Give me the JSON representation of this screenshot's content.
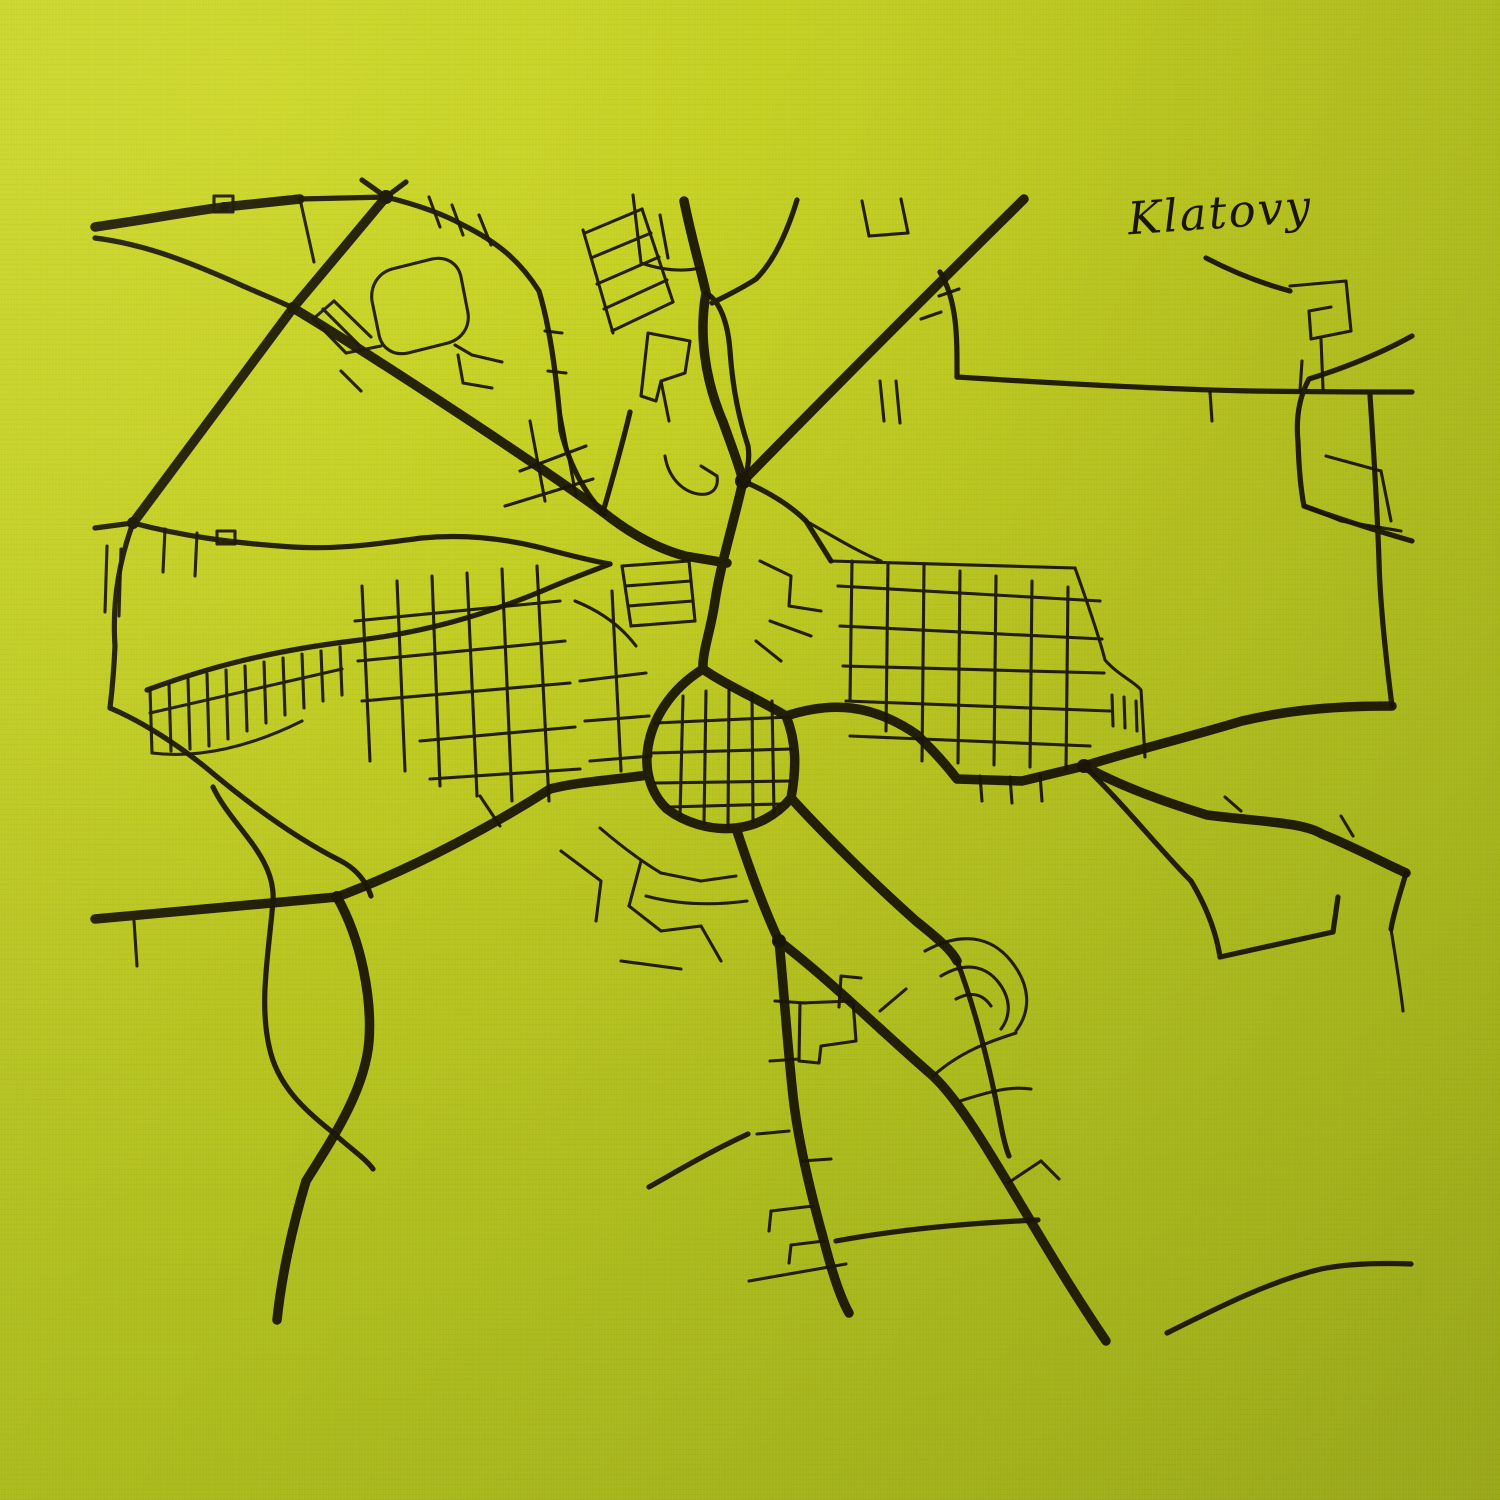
{
  "title": {
    "text": "Klatovy"
  },
  "colors": {
    "fabric_light": "#ccd726",
    "fabric_mid": "#b9c51f",
    "fabric_dark": "#a7b61b",
    "ink": "#1b1606"
  },
  "map": {
    "viewbox": "0 0 1500 1500",
    "layers": [
      {
        "name": "primary-roads",
        "width": 9.5,
        "paths": [
          "M95,227 C150,219 192,211 224,207 L300,199",
          "M386,197 L340,252 L293,308",
          "M293,308 L133,523",
          "M293,308 C360,348 520,452 603,512 C628,532 655,548 685,556 L727,563",
          "M1024,199 C950,272 830,392 743,481",
          "M684,201 C692,240 700,266 706,293 C699,332 704,378 723,422 C733,450 739,465 743,481",
          "M743,481 C734,522 721,562 715,601 C711,630 702,652 703,669",
          "M703,669 C722,683 762,701 786,716 C796,741 797,766 791,798 C776,816 756,826 736,828 C710,831 684,822 667,809 C651,794 644,771 648,747 C652,721 669,690 703,669",
          "M786,716 C832,701 872,704 916,734 C936,753 947,766 957,779 L1022,781 L1084,766",
          "M1084,766 C1132,751 1182,739 1242,721 C1292,709 1342,706 1392,706",
          "M1084,766 C1120,786 1162,801 1207,815 C1262,822 1302,822 1322,834 C1352,846 1382,862 1406,873",
          "M648,775 C612,780 577,782 550,789 C500,821 420,866 337,897",
          "M337,897 L95,919",
          "M337,897 C362,941 372,1000 369,1041 C365,1091 331,1141 306,1181 C291,1231 281,1281 277,1320",
          "M736,828 C750,871 765,911 779,941",
          "M779,941 C784,991 787,1041 793,1096 C798,1141 810,1191 824,1241 C833,1276 841,1299 849,1313",
          "M779,941 C831,981 881,1031 933,1076 C976,1116 1031,1231 1106,1341",
          "M791,798 C821,831 871,881 916,921 C941,941 952,951 957,961"
        ]
      },
      {
        "name": "secondary-roads",
        "width": 5.2,
        "paths": [
          "M386,197 L362,180",
          "M386,197 L406,182",
          "M300,199 L386,197",
          "M386,197 C422,206 447,216 463,225 C501,244 521,263 539,291 C551,331 557,381 561,431 C571,471 589,498 603,512",
          "M95,238 C142,244 182,259 232,281 C258,293 277,300 293,308",
          "M95,528 L133,523",
          "M133,523 C182,536 232,543 292,547 C342,550 382,543 422,538 C462,534 502,538 542,548 C572,556 592,561 610,564",
          "M133,523 C119,561 112,601 115,646 C114,669 112,691 110,708",
          "M706,293 C720,301 728,323 730,351 C733,393 740,421 748,446 C750,459 748,470 743,481",
          "M797,200 C786,236 772,263 756,279 C741,289 726,296 712,303",
          "M940,272 C958,302 957,341 957,377",
          "M957,377 C1050,383 1152,389 1252,391 C1322,392 1372,392 1412,392",
          "M1392,706 C1385,651 1380,601 1379,561 C1377,501 1373,441 1370,395",
          "M1412,336 C1376,356 1341,369 1309,379 C1298,399 1296,421 1298,442 C1299,471 1301,491 1304,506",
          "M1304,506 C1331,516 1371,529 1412,541",
          "M1084,766 C1121,801 1161,851 1191,881 C1206,906 1216,931 1220,957",
          "M1220,957 L1333,932",
          "M1333,932 L1338,897",
          "M1406,873 C1401,891 1394,911 1391,929",
          "M147,690 C212,666 272,651 352,641 C422,633 482,616 542,591 C572,578 592,571 610,564",
          "M110,708 C141,721 181,746 216,776 C256,809 301,841 341,861 C356,869 366,881 371,896",
          "M213,787 C231,826 276,856 273,901 C269,951 259,1001 269,1046 C277,1086 306,1111 331,1131 C351,1149 366,1159 373,1169",
          "M1167,1333 C1221,1306 1271,1281 1321,1269 C1351,1263 1386,1263 1411,1264",
          "M957,961 C976,1011 991,1073 1001,1126 C1004,1141 1006,1149 1009,1156",
          "M836,1241 C901,1229 971,1223 1038,1220",
          "M748,1134 C711,1151 681,1169 649,1187",
          "M603,512 C613,477 622,446 630,412",
          "M743,481 C771,493 791,506 806,521 L831,561",
          "M1290,291 C1260,283 1231,271 1206,258"
        ]
      },
      {
        "name": "minor-streets",
        "width": 3.1,
        "paths": [
          "M585,233 L642,209",
          "M591,258 L651,233",
          "M597,284 L659,257",
          "M604,309 L667,280",
          "M612,331 L673,302",
          "M583,230 L613,333",
          "M642,209 L673,302",
          "M633,195 L641,263",
          "M641,263 C662,270 682,272 700,268",
          "M648,333 L690,341 L685,373 L661,381 L656,401 L641,396 Z",
          "M661,381 L669,421",
          "M660,215 L668,258",
          "M862,201 L869,236",
          "M901,199 L908,233",
          "M869,236 L908,233",
          "M429,197 L440,227",
          "M452,205 L463,235",
          "M479,215 L491,245",
          "M545,331 L562,333",
          "M548,371 L566,373",
          "M313,319 L346,353",
          "M323,309 L359,345",
          "M334,301 L371,337",
          "M313,319 L334,301",
          "M346,353 L381,346",
          "M341,371 L361,391",
          "M300,199 L314,262",
          "M372,301 C370,286 378,273 392,269 L432,259 C446,256 458,263 461,277 L468,313 C470,327 462,339 448,343 L408,353 C394,356 382,349 379,335 Z",
          "M455,345 L472,355 L502,362",
          "M458,355 L463,383 L492,388",
          "M214,196 L233,196 L233,212 L214,212 Z",
          "M217,531 L235,531 L235,544 L217,544 Z",
          "M165,529 L163,572",
          "M197,533 L195,576",
          "M107,546 L105,612",
          "M121,549 L119,616",
          "M134,921 L137,966",
          "M150,689 L152,753",
          "M169,684 L171,751",
          "M188,679 L190,749",
          "M207,674 L209,746",
          "M226,670 L228,739",
          "M245,666 L247,731",
          "M264,662 L266,723",
          "M283,658 L285,715",
          "M302,654 L304,708",
          "M321,651 L323,701",
          "M340,647 L342,695",
          "M150,713 L342,669",
          "M152,753 C200,759 252,746 302,721",
          "M362,586 L370,761",
          "M397,581 L405,771",
          "M432,576 L440,786",
          "M467,573 L477,796",
          "M502,569 L512,801",
          "M537,566 L549,801",
          "M355,621 L560,601",
          "M358,661 L565,641",
          "M362,701 L570,683",
          "M420,741 L575,727",
          "M430,779 L580,769",
          "M480,796 L500,826",
          "M520,471 L586,446",
          "M505,506 L593,479",
          "M530,421 L545,501",
          "M560,411 L576,496",
          "M575,601 C600,611 621,626 636,646",
          "M580,681 L646,673",
          "M585,721 L649,716",
          "M590,761 L651,756",
          "M612,591 L621,771",
          "M622,566 L689,561",
          "M625,586 L691,581",
          "M628,606 L693,601",
          "M631,626 L695,621",
          "M622,566 L631,626",
          "M689,561 L695,621",
          "M683,696 L680,816",
          "M706,691 L704,823",
          "M729,689 L728,826",
          "M752,693 L753,821",
          "M772,701 L774,813",
          "M655,723 L790,717",
          "M652,753 L792,749",
          "M655,783 L790,781",
          "M668,807 L780,804",
          "M665,456 C668,476 681,491 698,494 C711,496 719,489 717,476 L701,466",
          "M760,561 L791,576 L789,606 L821,611",
          "M770,621 L811,636",
          "M756,641 L781,661",
          "M806,521 C841,541 861,553 881,561",
          "M880,381 L884,421",
          "M896,381 L900,423",
          "M852,561 L850,701",
          "M888,563 L886,731",
          "M924,566 L922,761",
          "M960,571 L958,763",
          "M996,576 L994,765",
          "M1032,581 L1030,767",
          "M1068,587 L1066,769",
          "M838,586 L1100,601",
          "M840,626 L1102,639",
          "M843,666 L1104,673",
          "M846,701 L1110,711",
          "M850,736 L1090,746",
          "M830,561 L1075,568",
          "M1075,568 C1090,610 1100,640 1105,660 C1118,675 1135,682 1141,690 L1145,757",
          "M1112,695 L1113,726",
          "M1124,697 L1125,728",
          "M1136,701 L1137,731",
          "M980,776 L982,801",
          "M1010,777 L1012,803",
          "M1040,775 L1042,801",
          "M1326,456 L1381,471",
          "M1381,471 L1391,521",
          "M1341,521 L1401,531",
          "M1304,506 L1341,521",
          "M1290,286 L1346,281 L1351,331 L1311,339 L1309,311 L1331,307",
          "M1321,339 L1323,389",
          "M941,312 L921,319",
          "M959,289 L939,296",
          "M1210,392 L1212,421",
          "M1300,391 L1302,361",
          "M1225,797 L1241,811",
          "M1341,816 L1353,836",
          "M1391,929 C1396,961 1401,991 1403,1011",
          "M925,951 C961,931 991,936 1011,961 C1031,986 1031,1011 1016,1031",
          "M941,976 C966,961 986,966 999,983 C1011,999 1011,1016 1001,1029",
          "M956,999 C971,991 983,994 991,1006",
          "M933,1076 C961,1051 991,1041 1016,1033",
          "M880,1011 L906,989",
          "M960,1101 C991,1091 1011,1086 1031,1089",
          "M1008,1183 L1041,1161",
          "M1041,1161 L1059,1179",
          "M600,828 C621,846 641,861 661,873",
          "M661,873 L701,881",
          "M701,881 L736,876",
          "M641,861 L629,906",
          "M629,906 L661,931 L701,926",
          "M561,851 L601,881 L596,921",
          "M701,926 L721,961",
          "M621,961 L681,969",
          "M800,1003 L853,1001 L856,1041 L821,1046 L819,1063 L799,1061 Z",
          "M839,1007 L841,976 L861,978",
          "M747,901 C710,906 676,904 646,896",
          "M775,1001 L806,1003",
          "M770,1061 L799,1059",
          "M789,1131 L757,1134",
          "M801,1161 L831,1159",
          "M813,1206 L771,1211",
          "M771,1211 L769,1231",
          "M824,1241 L791,1245",
          "M791,1245 L789,1263",
          "M749,1281 L846,1264"
        ]
      }
    ],
    "junction_dots": [
      [
        386,
        197,
        7
      ],
      [
        293,
        308,
        6
      ],
      [
        133,
        523,
        6
      ],
      [
        743,
        481,
        8
      ],
      [
        603,
        512,
        5
      ],
      [
        1084,
        766,
        7
      ],
      [
        779,
        941,
        7
      ],
      [
        337,
        897,
        6
      ],
      [
        224,
        207,
        5
      ]
    ]
  }
}
